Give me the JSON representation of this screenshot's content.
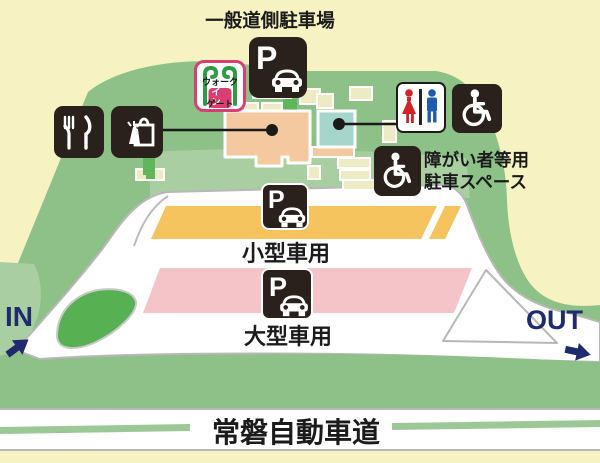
{
  "map": {
    "labels": {
      "general_parking": "一般道側駐車場",
      "disabled_parking_line1": "障がい者等用",
      "disabled_parking_line2": "駐車スペース",
      "small_car": "小型車用",
      "large_car": "大型車用",
      "highway": "常磐自動車道",
      "in_label": "IN",
      "out_label": "OUT"
    },
    "parking_letter": "P",
    "gate": {
      "word1": "ウォーク",
      "word2": "イン",
      "word3": "ゲート"
    },
    "icons": {
      "general_parking": "parking-car-icon",
      "restaurant": "fork-knife-icon",
      "shopping": "shopping-bag-icon",
      "walk_in_gate": "walk-in-gate-icon",
      "restroom": "male-female-restroom-icon",
      "accessible": "wheelchair-icon",
      "small_car_parking": "parking-car-icon",
      "large_car_parking": "parking-car-icon"
    },
    "colors": {
      "background_cream": "#F6F2C2",
      "hill_green": "#8DC188",
      "pale_green": "#A9CEA2",
      "island_green": "#57B153",
      "road_outline": "#B8B8B6",
      "small_car_strip": "#F5C45F",
      "large_car_strip": "#F5C4C9",
      "main_building": "#F4C9A0",
      "restroom_building": "#A6D5CC",
      "small_building": "#EDEBC4",
      "icon_plate": "#2A211C",
      "in_out_navy": "#1F2B6E",
      "female_red": "#D2232A",
      "male_blue": "#1D5CAE",
      "gate_green": "#2E9C46",
      "gate_pink": "#D84071"
    }
  }
}
